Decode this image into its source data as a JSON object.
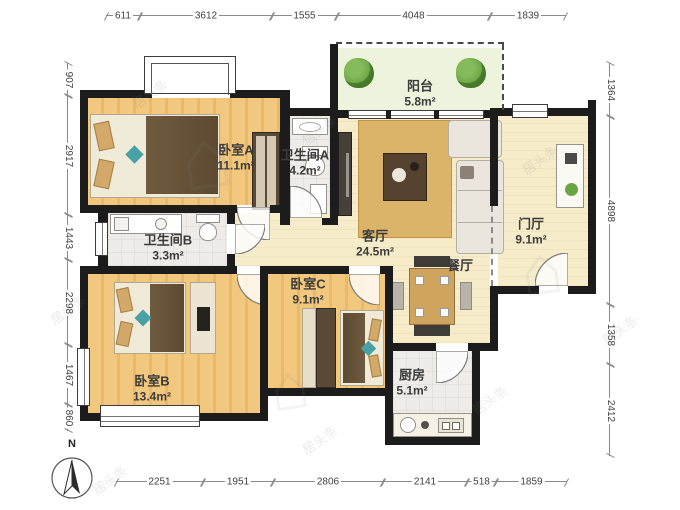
{
  "plan": {
    "type": "apartment-floor-plan",
    "compass_label": "N",
    "watermark_text": "居头条"
  },
  "rooms": {
    "bedroomA": {
      "name": "卧室A",
      "area": "11.1m²"
    },
    "bathroomA": {
      "name": "卫生间A",
      "area": "4.2m²"
    },
    "balcony": {
      "name": "阳台",
      "area": "5.8m²"
    },
    "living": {
      "name": "客厅",
      "area": "24.5m²"
    },
    "entry": {
      "name": "门厅",
      "area": "9.1m²"
    },
    "dining": {
      "name": "餐厅",
      "area": ""
    },
    "bathroomB": {
      "name": "卫生间B",
      "area": "3.3m²"
    },
    "bedroomC": {
      "name": "卧室C",
      "area": "9.1m²"
    },
    "bedroomB": {
      "name": "卧室B",
      "area": "13.4m²"
    },
    "kitchen": {
      "name": "厨房",
      "area": "5.1m²"
    }
  },
  "dims": {
    "top": [
      "611",
      "3612",
      "1555",
      "4048",
      "1839"
    ],
    "bottom": [
      "2251",
      "1951",
      "2806",
      "2141",
      "518",
      "1859"
    ],
    "left": [
      "907",
      "2917",
      "1443",
      "2298",
      "1467",
      "860"
    ],
    "right": [
      "1364",
      "4898",
      "1358",
      "2412"
    ]
  },
  "colors": {
    "wall": "#1c1c1c",
    "wood_floor": "#f0c37c",
    "tile_floor": "#edece8",
    "hall_floor": "#f6ecca",
    "balcony_floor": "#eef3dd",
    "plant_green": "#5f9b3a",
    "blanket_brown": "#6b573c",
    "accent_teal": "#49a1a6",
    "rug_tan": "#dcb469"
  }
}
